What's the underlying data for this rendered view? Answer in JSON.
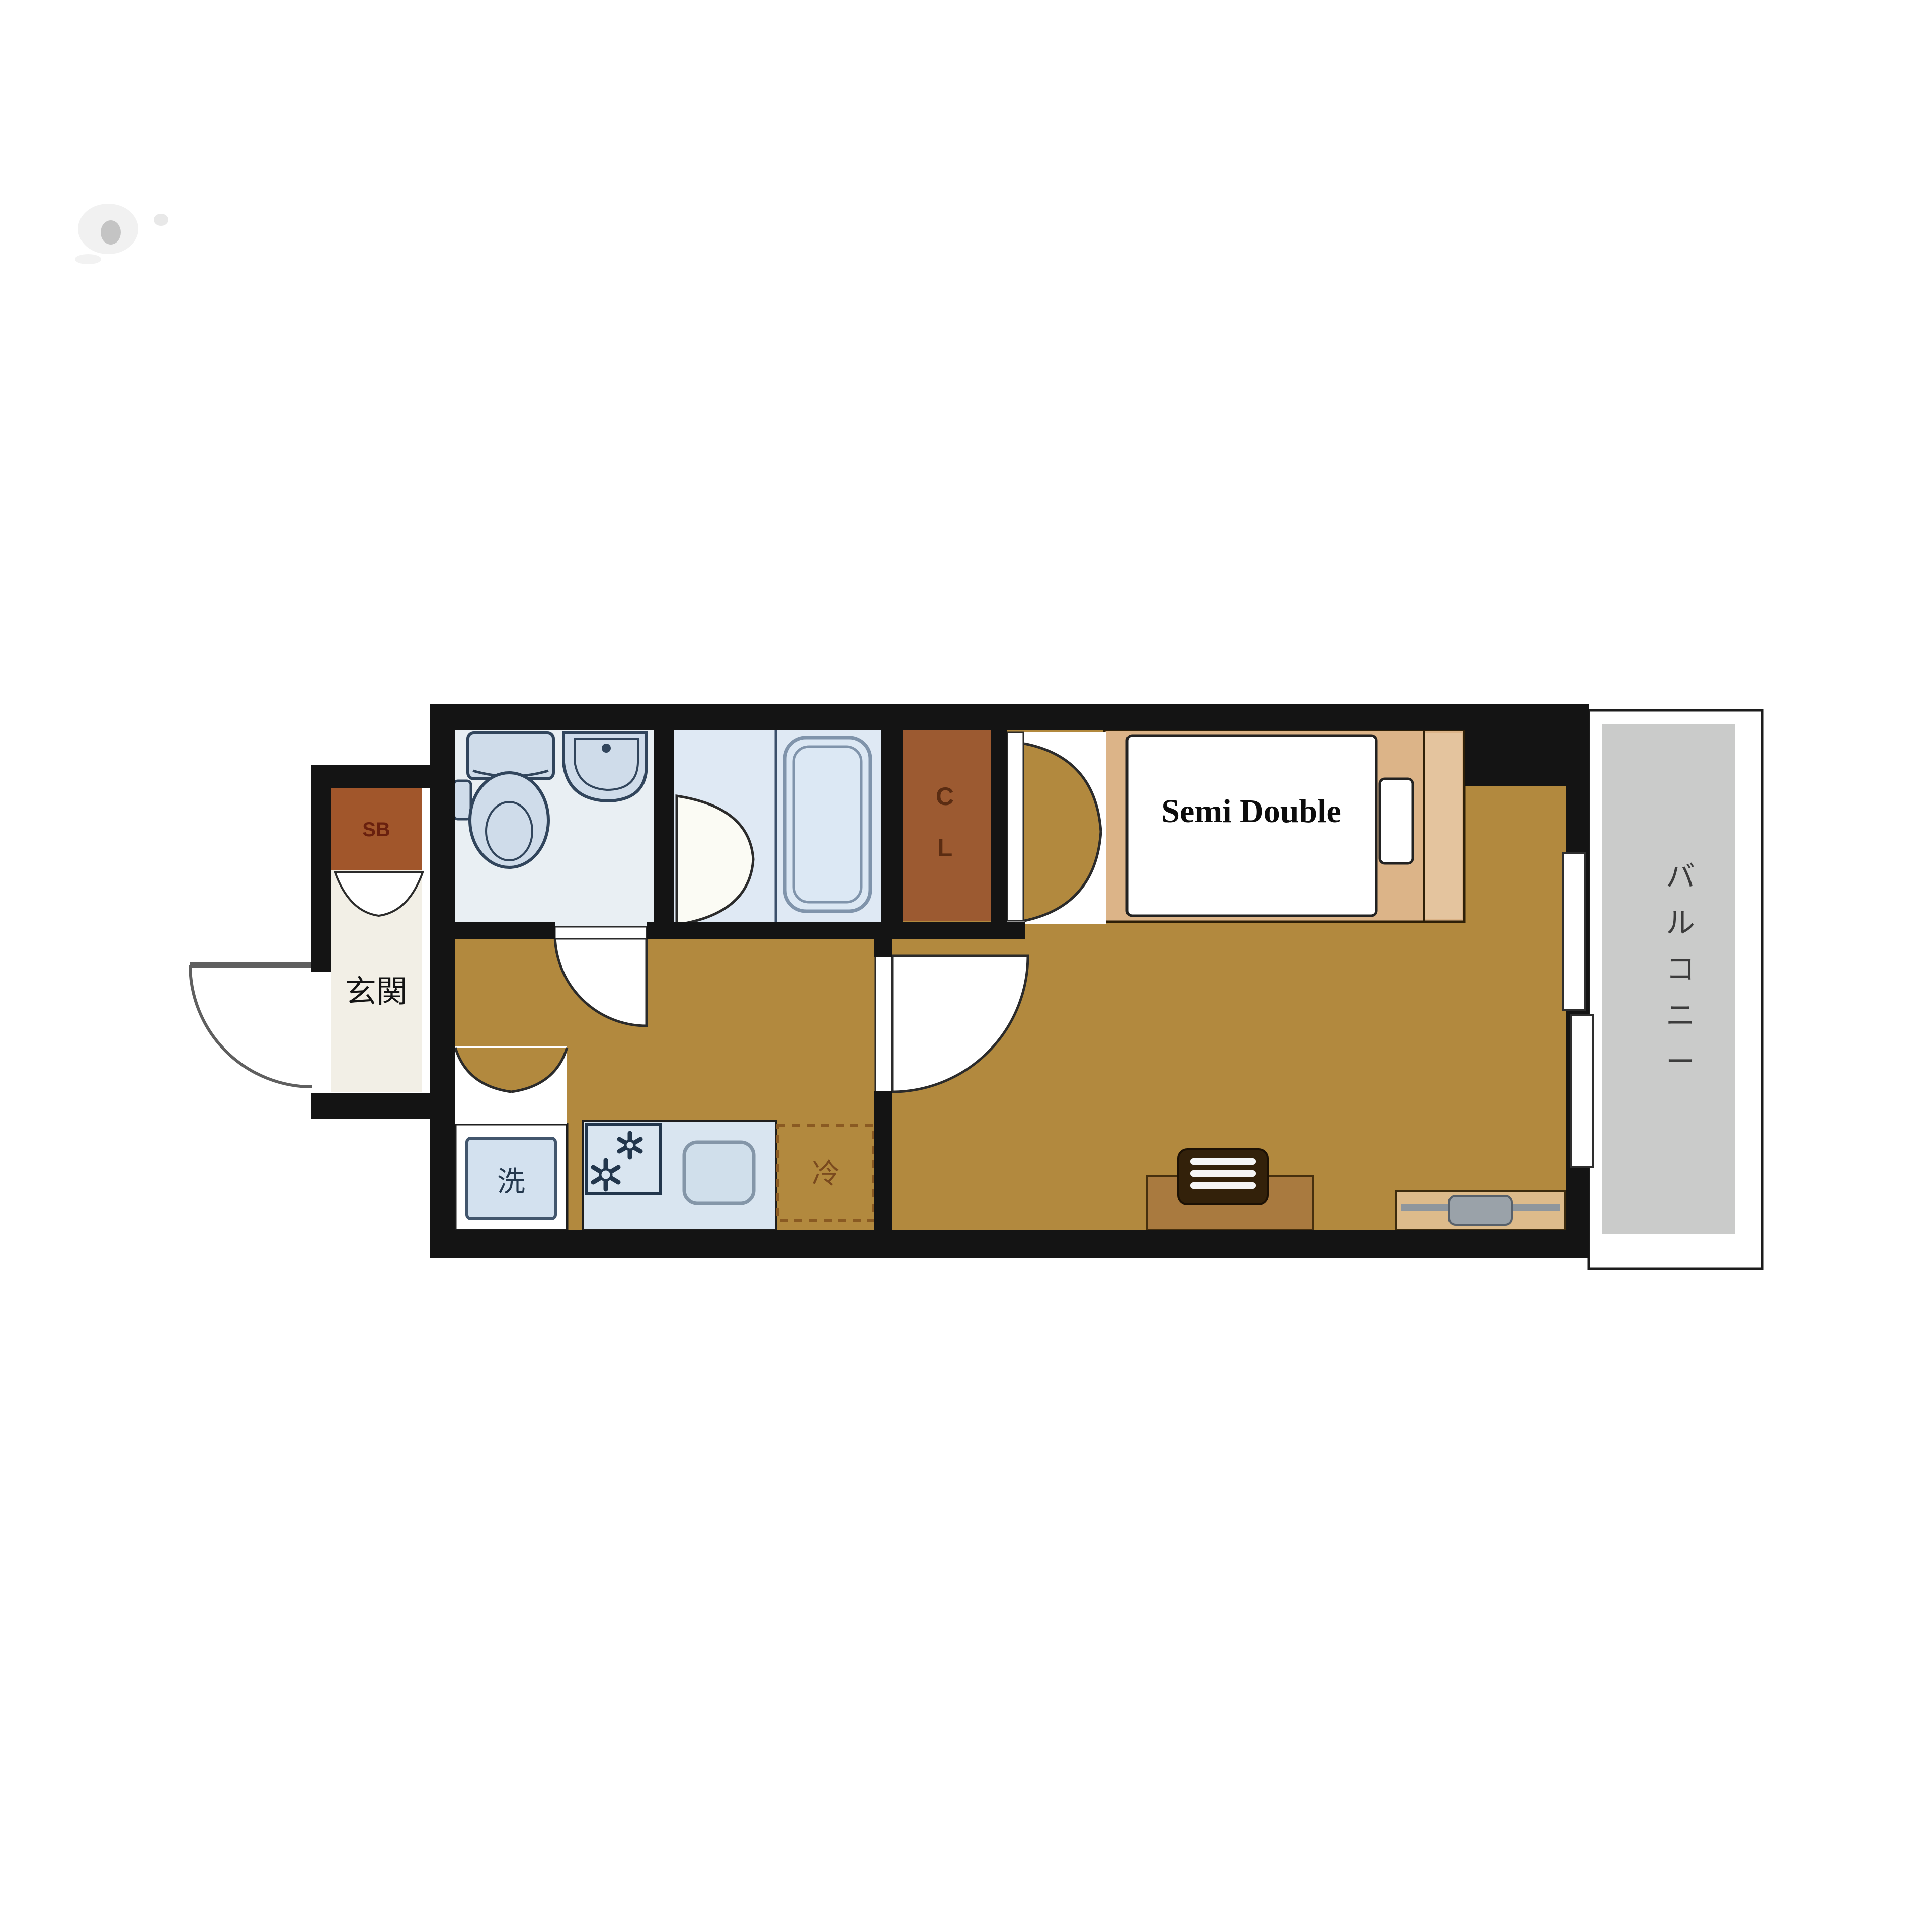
{
  "labels": {
    "entrance": "玄関",
    "shoe_box": "SB",
    "closet": "CL",
    "bed": "Semi Double",
    "balcony": "バルコニー",
    "washing_machine": "洗",
    "refrigerator": "冷"
  },
  "colors": {
    "floor": "#b2893e",
    "wall": "#141414",
    "genkan_floor": "#f2efe6",
    "toilet_floor": "#e9eff3",
    "bath_floor": "#dfe9f4",
    "fixture_fill": "#cfdcea",
    "fixture_outline": "#31455c",
    "closet_brown": "#9c5a31",
    "shoe_box_brown": "#a1562b",
    "bed_frame": "#dcb488",
    "bed_frame_light": "#e4c49e",
    "balcony_gray": "#cacbca",
    "kitchen_panel": "#d9e5f0",
    "kitchen_sink": "#d0dfeb",
    "washer_inner": "#d3e1ef",
    "desk_brown": "#a97a3f",
    "chair_brown": "#33210a",
    "tv_board": "#ddbb8b",
    "tv_gray": "#9aa2a9",
    "door_stroke": "#2b2b2b",
    "entry_door_stroke": "#5f5f5f"
  }
}
